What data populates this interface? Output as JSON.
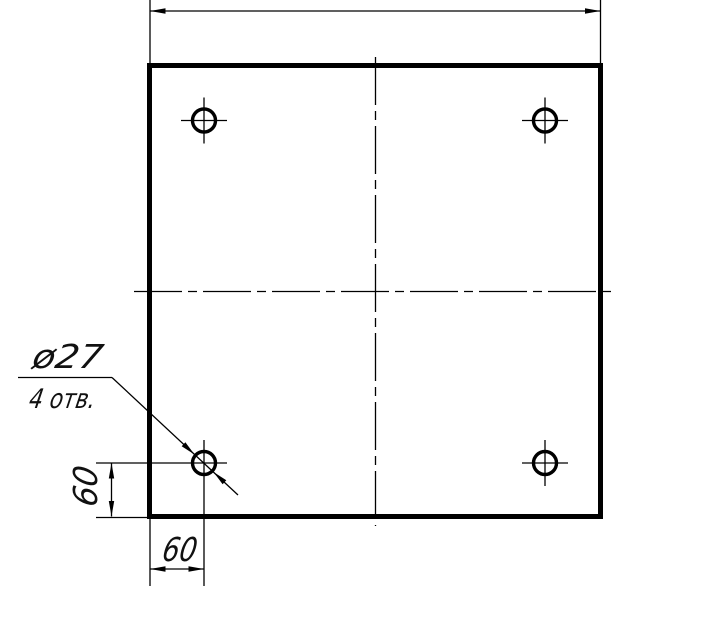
{
  "drawing": {
    "type": "engineering-drawing",
    "subject": "square-plate-with-four-holes",
    "colors": {
      "line": "#000000",
      "background": "#ffffff",
      "text": "#111111"
    },
    "callout": {
      "diameter": "ø27",
      "count": "4 отв."
    },
    "dimensions": {
      "left_offset": "60",
      "bottom_offset": "60"
    },
    "holes": {
      "count": 4
    }
  }
}
